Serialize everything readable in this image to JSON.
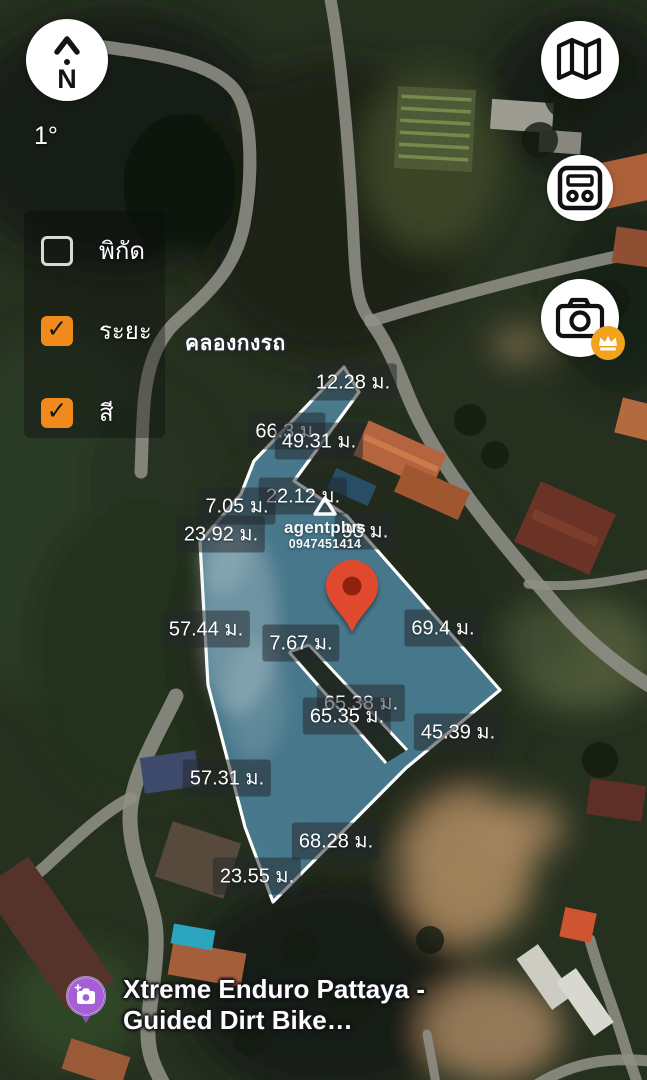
{
  "compass": {
    "bearing": "1°",
    "cardinal": "N"
  },
  "map_buttons": [
    {
      "id": "map-style",
      "icon": "map-icon"
    },
    {
      "id": "card-panel",
      "icon": "card-panel-icon"
    },
    {
      "id": "camera",
      "icon": "camera-icon",
      "badge_icon": "crown-icon",
      "badge_color": "#F2A21D"
    }
  ],
  "layer_panel": {
    "checkbox_color": "#F08A1D",
    "items": [
      {
        "label": "พิกัด",
        "checked": false
      },
      {
        "label": "ระยะ",
        "checked": true
      },
      {
        "label": "สี",
        "checked": true
      }
    ]
  },
  "place_labels": [
    {
      "text": "คลองกงรถ"
    }
  ],
  "poi": {
    "icon": "photo-camera-pin",
    "color": "#9B59C9",
    "line1": "Xtreme Enduro Pattaya -",
    "line2": "Guided Dirt Bike…"
  },
  "watermark": {
    "logo": "triangle-logo",
    "brand": "agentplus",
    "phone": "0947451414"
  },
  "marker": {
    "type": "red-map-pin",
    "color": "#E1492E",
    "x": 352,
    "y": 632
  },
  "parcel": {
    "fill": "#63B0DD",
    "fill_opacity": 0.58,
    "stroke": "#FFFFFF",
    "outline": [
      [
        344,
        367
      ],
      [
        359,
        392
      ],
      [
        294,
        481
      ],
      [
        347,
        516
      ],
      [
        500,
        690
      ],
      [
        406,
        768
      ],
      [
        273,
        902
      ],
      [
        245,
        827
      ],
      [
        208,
        685
      ],
      [
        200,
        542
      ],
      [
        241,
        494
      ],
      [
        254,
        461
      ]
    ],
    "road_cut": [
      [
        289,
        652
      ],
      [
        309,
        645
      ],
      [
        407,
        750
      ],
      [
        386,
        763
      ]
    ]
  },
  "measurements": [
    {
      "text": "12.28 ม.",
      "x": 353,
      "y": 382
    },
    {
      "text": "66.3 ม.",
      "x": 287,
      "y": 431
    },
    {
      "text": "49.31 ม.",
      "x": 319,
      "y": 441
    },
    {
      "text": "22.12 ม.",
      "x": 303,
      "y": 496
    },
    {
      "text": "7.05 ม.",
      "x": 237,
      "y": 506
    },
    {
      "text": "23.92 ม.",
      "x": 221,
      "y": 534
    },
    {
      "text": "93 ม.",
      "x": 365,
      "y": 531
    },
    {
      "text": "57.44 ม.",
      "x": 206,
      "y": 629
    },
    {
      "text": "7.67 ม.",
      "x": 301,
      "y": 643
    },
    {
      "text": "69.4 ม.",
      "x": 443,
      "y": 628
    },
    {
      "text": "65.38 ม.",
      "x": 361,
      "y": 703
    },
    {
      "text": "65.35 ม.",
      "x": 347,
      "y": 716
    },
    {
      "text": "45.39 ม.",
      "x": 458,
      "y": 732
    },
    {
      "text": "57.31 ม.",
      "x": 227,
      "y": 778
    },
    {
      "text": "68.28 ม.",
      "x": 336,
      "y": 841
    },
    {
      "text": "23.55 ม.",
      "x": 257,
      "y": 876
    }
  ]
}
